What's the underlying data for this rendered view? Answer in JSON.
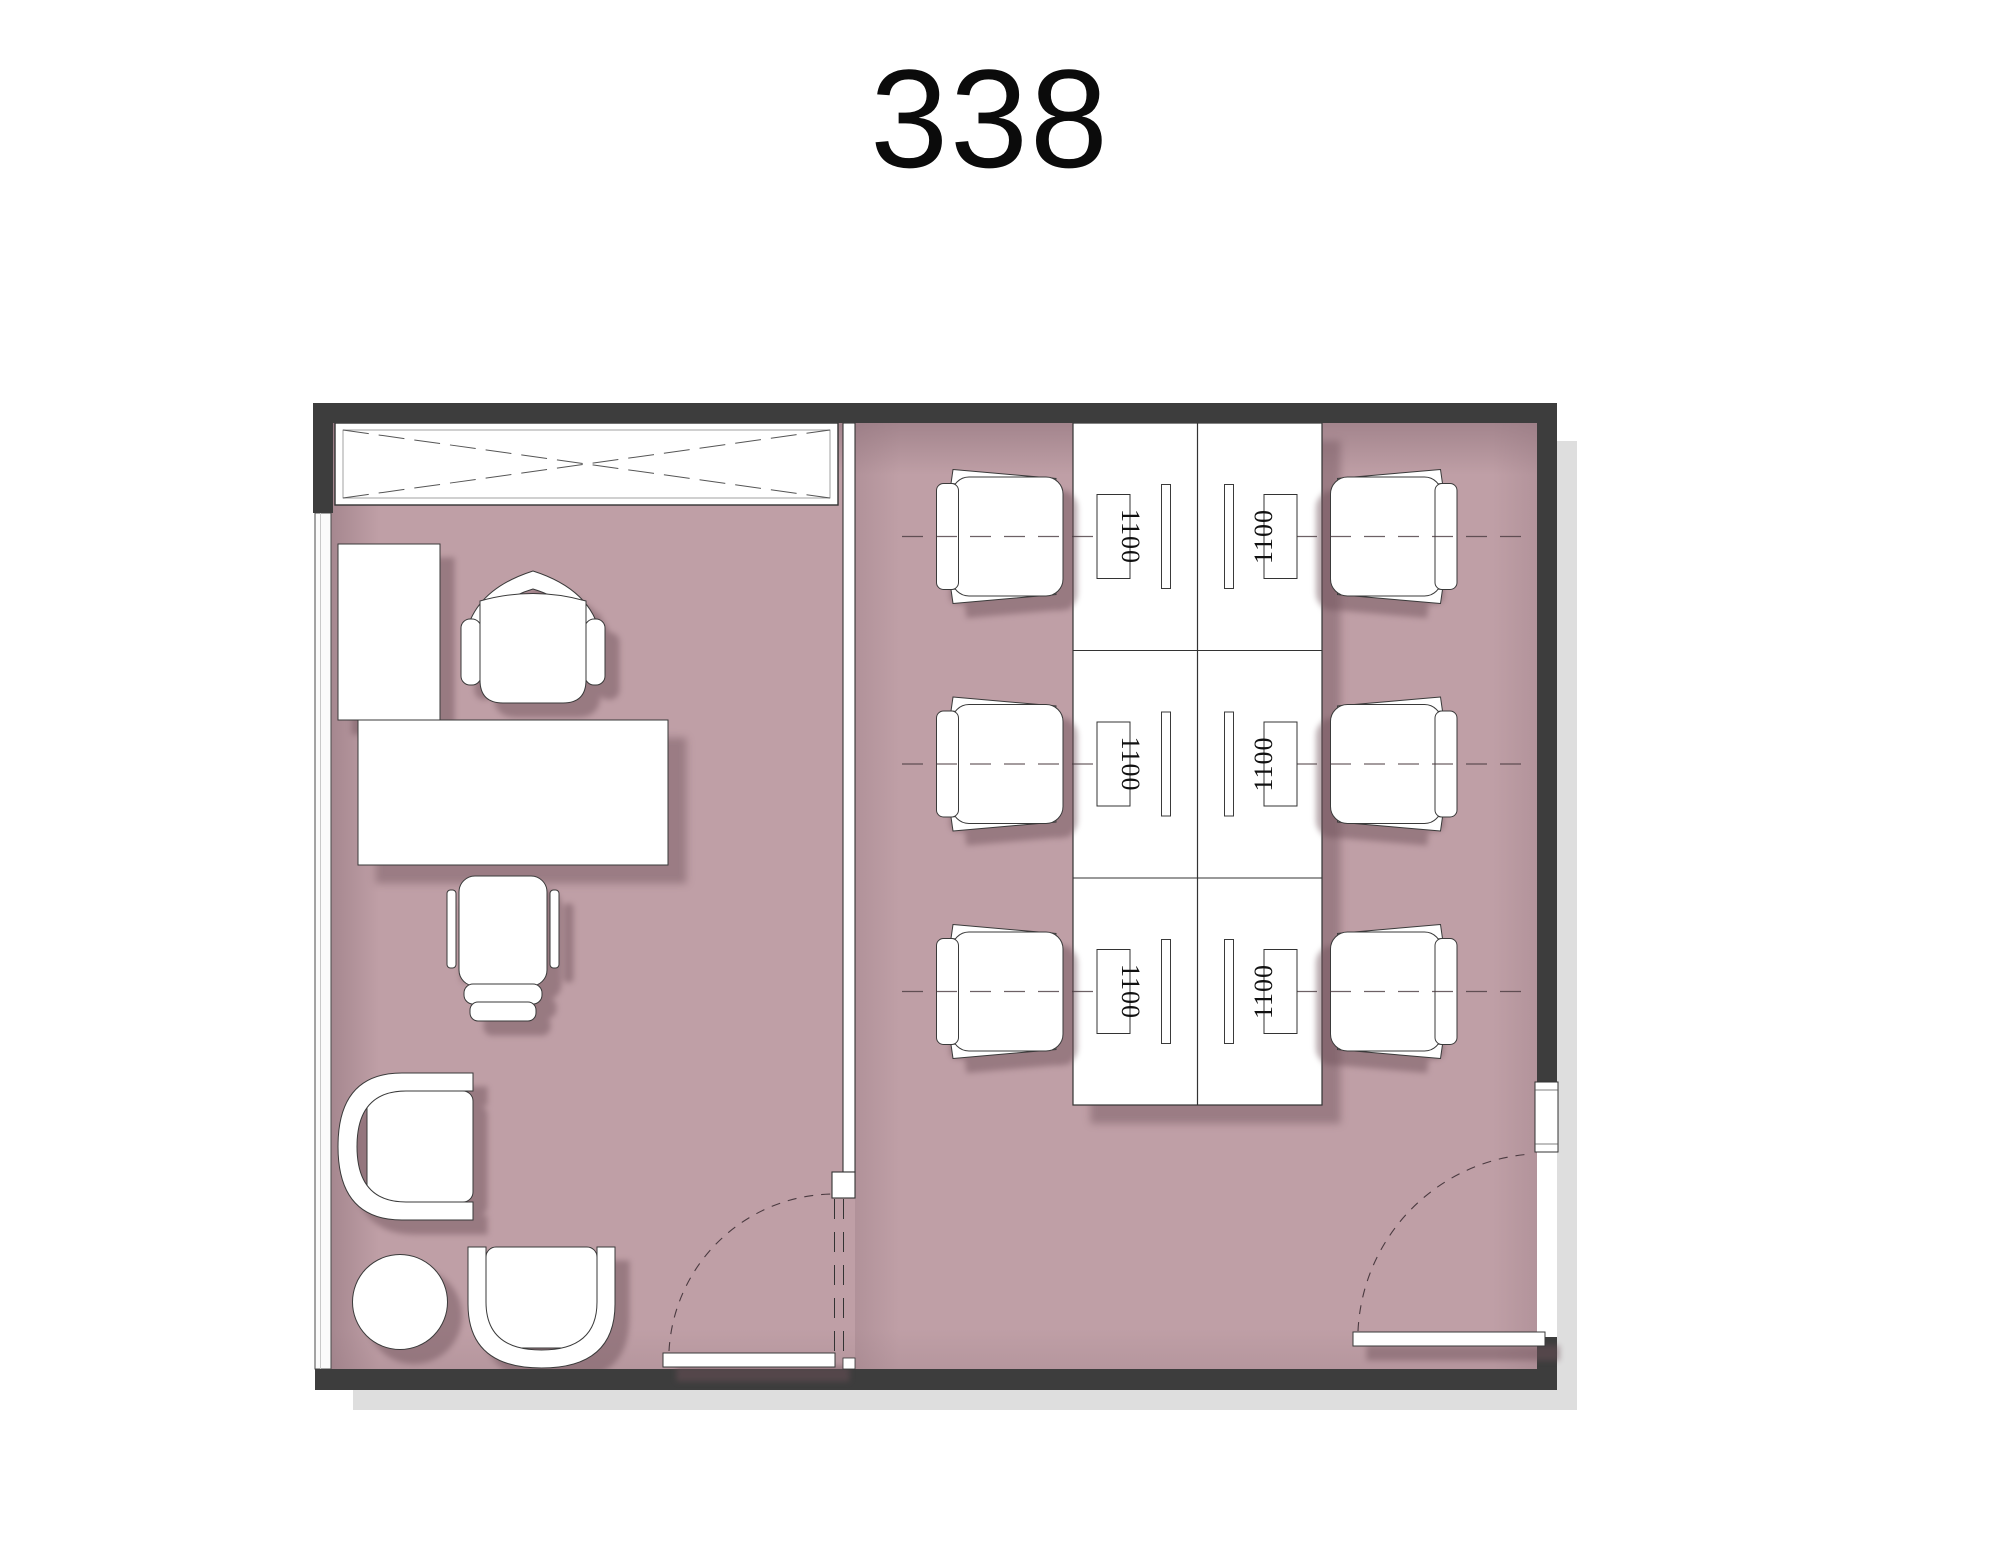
{
  "title": "338",
  "colors": {
    "floor": "#bf9fa6",
    "wall": "#3d3d3d",
    "furniture_outline": "#3a3a3a",
    "page_shadow": "#dedede"
  },
  "left_room": {
    "furniture": [
      "crossed-casework",
      "storage-cabinet",
      "executive-desk",
      "executive-chair",
      "visitor-chair",
      "lounge-armchair-east",
      "round-side-table",
      "lounge-armchair-north"
    ]
  },
  "right_room": {
    "workstation_rows": 3,
    "workstation_columns": 2,
    "desk_labels": [
      "1100",
      "1100",
      "1100",
      "1100",
      "1100",
      "1100"
    ]
  }
}
